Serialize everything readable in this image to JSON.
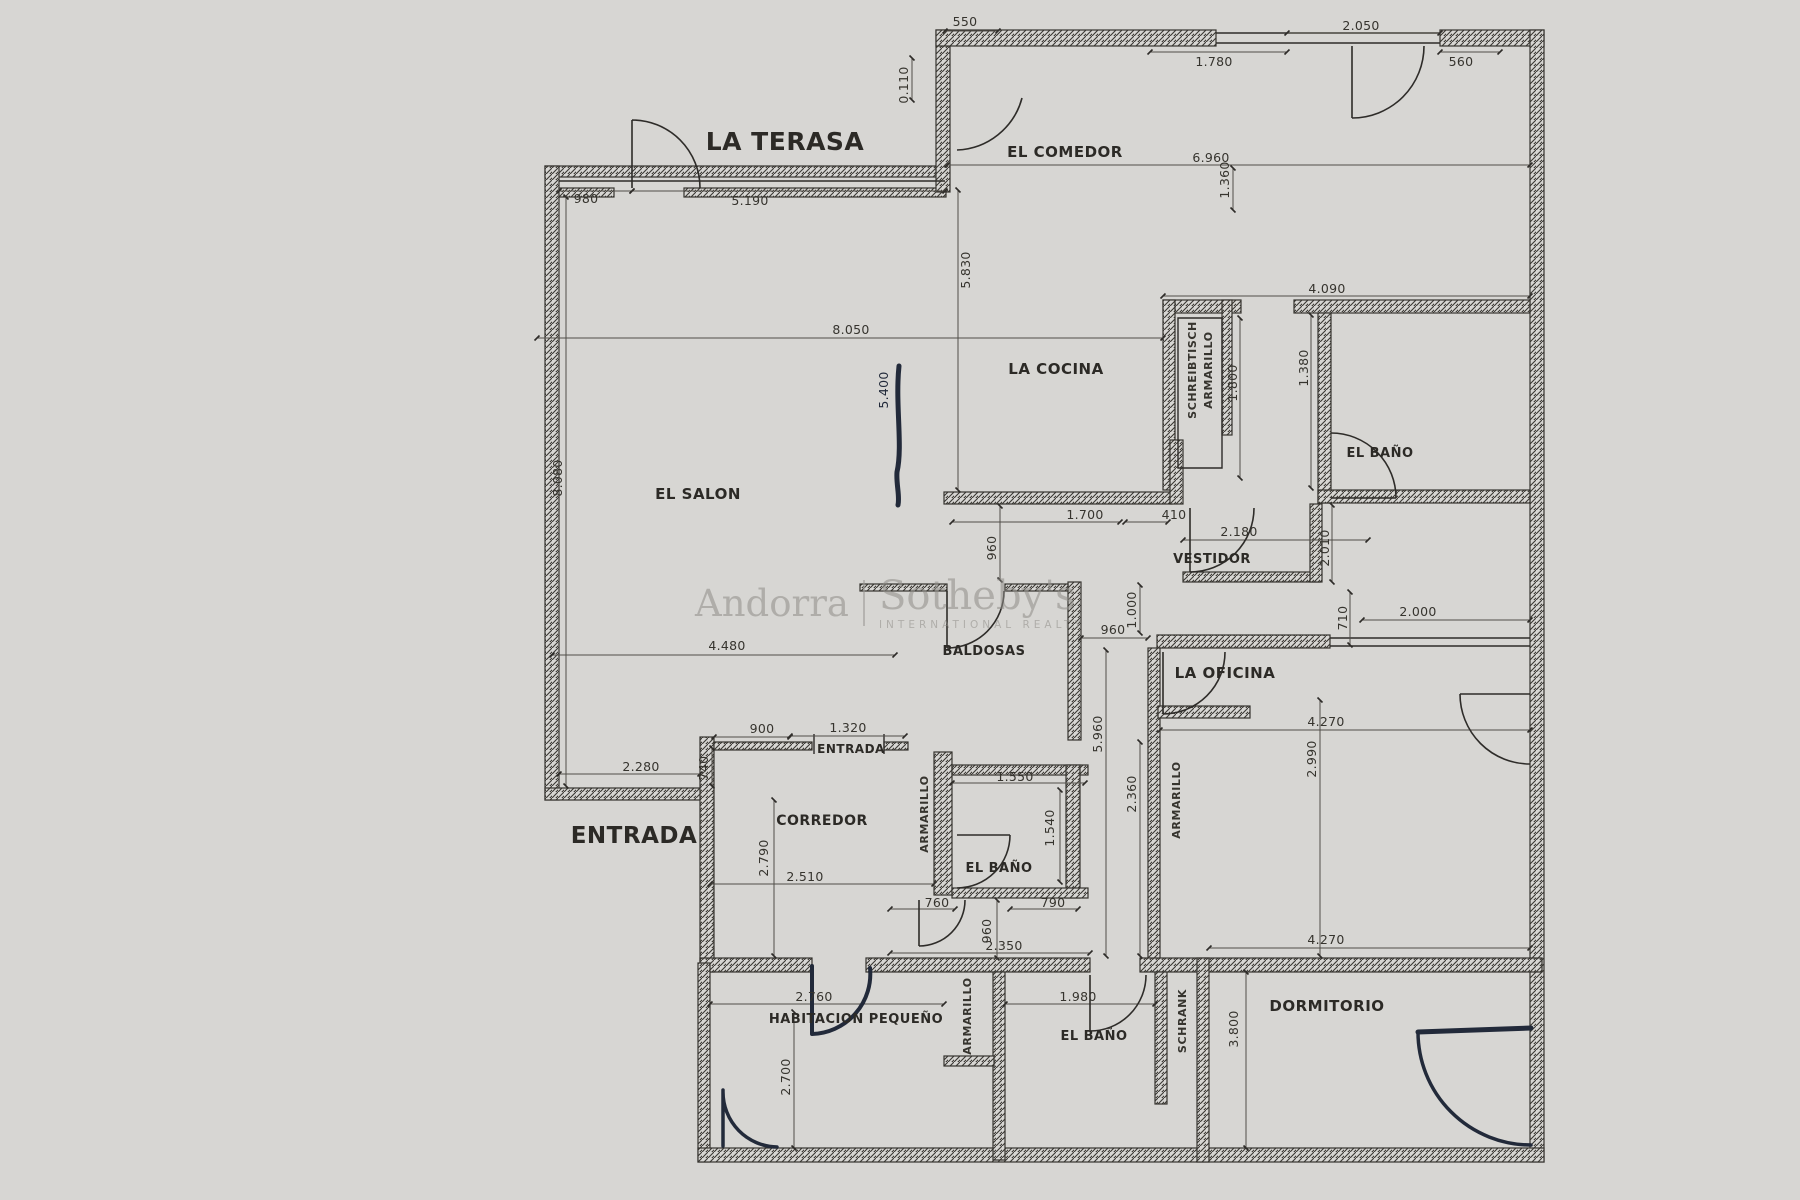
{
  "watermark": {
    "brand_left": "Andorra",
    "brand_right": "Sotheby's",
    "tagline": "INTERNATIONAL REALTY"
  },
  "colors": {
    "background": "#d7d6d3",
    "wall": "#2e2c29",
    "ink": "#1c2433",
    "dim_text": "#36342e",
    "watermark": "#8f8d88"
  },
  "rooms": [
    {
      "label": "LA TERASA"
    },
    {
      "label": "EL COMEDOR"
    },
    {
      "label": "LA COCINA"
    },
    {
      "label": "EL BAÑO"
    },
    {
      "label": "VESTIDOR"
    },
    {
      "label": "EL SALON"
    },
    {
      "label": "BALDOSAS"
    },
    {
      "label": "LA OFICINA"
    },
    {
      "label": "ENTRADA"
    },
    {
      "label": "CORREDOR"
    },
    {
      "label": "EL BAÑO"
    },
    {
      "label": "ENTRADA"
    },
    {
      "label": "HABITACION PEQUEÑO"
    },
    {
      "label": "EL BAÑO"
    },
    {
      "label": "DORMITORIO"
    }
  ],
  "closets": [
    {
      "label": "SCHREIBTISCH"
    },
    {
      "label": "ARMARILLO"
    },
    {
      "label": "ARMARILLO"
    },
    {
      "label": "ARMARILLO"
    },
    {
      "label": "ARMARILLO"
    },
    {
      "label": "SCHRANK"
    }
  ],
  "dimensions": [
    {
      "value": "550"
    },
    {
      "value": "1.780"
    },
    {
      "value": "2.050"
    },
    {
      "value": "560"
    },
    {
      "value": "0.110"
    },
    {
      "value": "980"
    },
    {
      "value": "5.190"
    },
    {
      "value": "6.960"
    },
    {
      "value": "1.360"
    },
    {
      "value": "5.830"
    },
    {
      "value": "8.050"
    },
    {
      "value": "4.090"
    },
    {
      "value": "1.800"
    },
    {
      "value": "1.380"
    },
    {
      "value": "5.400"
    },
    {
      "value": "8.080"
    },
    {
      "value": "960"
    },
    {
      "value": "1.700"
    },
    {
      "value": "410"
    },
    {
      "value": "2.180"
    },
    {
      "value": "2.010"
    },
    {
      "value": "710"
    },
    {
      "value": "2.000"
    },
    {
      "value": "960"
    },
    {
      "value": "1.000"
    },
    {
      "value": "4.480"
    },
    {
      "value": "5.960"
    },
    {
      "value": "2.360"
    },
    {
      "value": "4.270"
    },
    {
      "value": "2.990"
    },
    {
      "value": "900"
    },
    {
      "value": "1.320"
    },
    {
      "value": "2.280"
    },
    {
      "value": "740"
    },
    {
      "value": "1.550"
    },
    {
      "value": "1.540"
    },
    {
      "value": "2.790"
    },
    {
      "value": "2.510"
    },
    {
      "value": "760"
    },
    {
      "value": "960"
    },
    {
      "value": "790"
    },
    {
      "value": "2.350"
    },
    {
      "value": "2.760"
    },
    {
      "value": "2.700"
    },
    {
      "value": "1.980"
    },
    {
      "value": "4.270"
    },
    {
      "value": "3.800"
    }
  ]
}
